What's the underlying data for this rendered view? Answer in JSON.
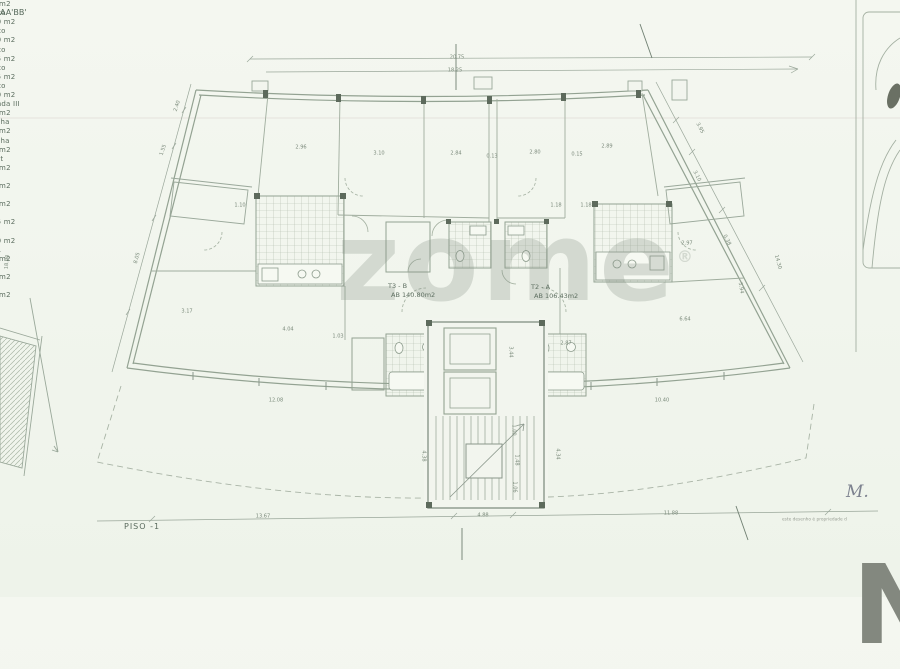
{
  "page": {
    "background": "#f2f5ee",
    "line_color": "#9aa89b",
    "text_color": "#5f6f64"
  },
  "watermark": {
    "text": "zome",
    "reg": "®"
  },
  "floor_label": "PISO -1",
  "corner": {
    "signature": "M.",
    "note": "este desenho é propriedade d",
    "logo_letter": "N"
  },
  "section_markers": [
    {
      "label": "A",
      "x": 461,
      "y": 40
    },
    {
      "label": "A'",
      "x": 467,
      "y": 566
    },
    {
      "label": "B",
      "x": 636,
      "y": 19
    },
    {
      "label": "B'",
      "x": 748,
      "y": 545
    }
  ],
  "apartments": [
    {
      "code": "T3 - B",
      "area": "AB 140.80m2",
      "x": 388,
      "y": 282
    },
    {
      "code": "T2 - A",
      "area": "AB 106.43m2",
      "x": 531,
      "y": 283
    }
  ],
  "rooms": [
    {
      "name": "Varanda",
      "area": "4.25 m2",
      "x": 206,
      "y": 198
    },
    {
      "name": "Quarto",
      "area": "12.60 m2",
      "x": 305,
      "y": 167
    },
    {
      "name": "Quarto",
      "area": "11.60 m2",
      "x": 390,
      "y": 167
    },
    {
      "name": "Quarto",
      "area": "12.25 m2",
      "x": 457,
      "y": 167
    },
    {
      "name": "Quarto",
      "area": "13.35 m2",
      "x": 531,
      "y": 166
    },
    {
      "name": "Quarto",
      "area": "13.00 m2",
      "x": 601,
      "y": 166
    },
    {
      "name": "Varanda III",
      "area": "4.25 m2",
      "x": 698,
      "y": 199
    },
    {
      "name": "Cozinha",
      "area": "8.10 m2",
      "x": 308,
      "y": 227
    },
    {
      "name": "Cozinha",
      "area": "8.63 m2",
      "x": 634,
      "y": 226
    },
    {
      "name": "Closet",
      "area": "4.00 m2",
      "x": 408,
      "y": 246
    },
    {
      "name": "I.S.",
      "area": "3.08 m2",
      "x": 469,
      "y": 247
    },
    {
      "name": "I.S.",
      "area": "2.65 m2",
      "x": 522,
      "y": 247
    },
    {
      "name": "Sala",
      "area": "37.55 m2",
      "x": 249,
      "y": 308
    },
    {
      "name": "Sala",
      "area": "31.20 m2",
      "x": 666,
      "y": 311
    },
    {
      "name": "Desp.",
      "area": "3.25 m2",
      "x": 368,
      "y": 359
    },
    {
      "name": "I.S.",
      "area": "5.40 m2",
      "x": 414,
      "y": 361
    },
    {
      "name": "I.S.",
      "area": "4.00 m2",
      "x": 567,
      "y": 361
    }
  ],
  "dimensions": [
    {
      "t": "20.75",
      "x": 457,
      "y": 57,
      "r": 0
    },
    {
      "t": "18.25",
      "x": 455,
      "y": 70,
      "r": 0
    },
    {
      "t": "2.40",
      "x": 177,
      "y": 106,
      "r": -72
    },
    {
      "t": "1.55",
      "x": 163,
      "y": 150,
      "r": -72
    },
    {
      "t": "8.05",
      "x": 137,
      "y": 258,
      "r": -75
    },
    {
      "t": "18.90",
      "x": 7,
      "y": 262,
      "r": -85
    },
    {
      "t": "3.95",
      "x": 700,
      "y": 128,
      "r": 63
    },
    {
      "t": "14.30",
      "x": 778,
      "y": 262,
      "r": 75
    },
    {
      "t": "2.96",
      "x": 301,
      "y": 147,
      "r": 0
    },
    {
      "t": "3.10",
      "x": 379,
      "y": 153,
      "r": 0
    },
    {
      "t": "2.84",
      "x": 456,
      "y": 153,
      "r": 0
    },
    {
      "t": "0.13",
      "x": 492,
      "y": 156,
      "r": 0
    },
    {
      "t": "2.80",
      "x": 535,
      "y": 152,
      "r": 0
    },
    {
      "t": "0.15",
      "x": 577,
      "y": 154,
      "r": 0
    },
    {
      "t": "2.89",
      "x": 607,
      "y": 146,
      "r": 0
    },
    {
      "t": "3.10",
      "x": 697,
      "y": 176,
      "r": 63
    },
    {
      "t": "1.18",
      "x": 556,
      "y": 205,
      "r": 0
    },
    {
      "t": "1.18",
      "x": 586,
      "y": 205,
      "r": 0
    },
    {
      "t": "1.10",
      "x": 240,
      "y": 205,
      "r": 0
    },
    {
      "t": "2.97",
      "x": 687,
      "y": 243,
      "r": 0
    },
    {
      "t": "0.38",
      "x": 727,
      "y": 240,
      "r": 63
    },
    {
      "t": "3.17",
      "x": 187,
      "y": 311,
      "r": 0
    },
    {
      "t": "4.04",
      "x": 288,
      "y": 329,
      "r": 0
    },
    {
      "t": "1.03",
      "x": 338,
      "y": 336,
      "r": 0
    },
    {
      "t": "6.64",
      "x": 685,
      "y": 319,
      "r": 0
    },
    {
      "t": "5.94",
      "x": 741,
      "y": 288,
      "r": 80
    },
    {
      "t": "12.08",
      "x": 276,
      "y": 400,
      "r": 0
    },
    {
      "t": "10.40",
      "x": 662,
      "y": 400,
      "r": 0
    },
    {
      "t": "4.38",
      "x": 424,
      "y": 456,
      "r": 90
    },
    {
      "t": "4.34",
      "x": 558,
      "y": 454,
      "r": 90
    },
    {
      "t": "3.44",
      "x": 511,
      "y": 352,
      "r": 90
    },
    {
      "t": "1.00",
      "x": 514,
      "y": 430,
      "r": 90
    },
    {
      "t": "1.48",
      "x": 517,
      "y": 460,
      "r": 90
    },
    {
      "t": "1.06",
      "x": 515,
      "y": 487,
      "r": 90
    },
    {
      "t": "2.87",
      "x": 566,
      "y": 343,
      "r": 0
    },
    {
      "t": "13.67",
      "x": 263,
      "y": 516,
      "r": 0
    },
    {
      "t": "4.88",
      "x": 483,
      "y": 515,
      "r": 0
    },
    {
      "t": "11.88",
      "x": 671,
      "y": 513,
      "r": 0
    }
  ]
}
